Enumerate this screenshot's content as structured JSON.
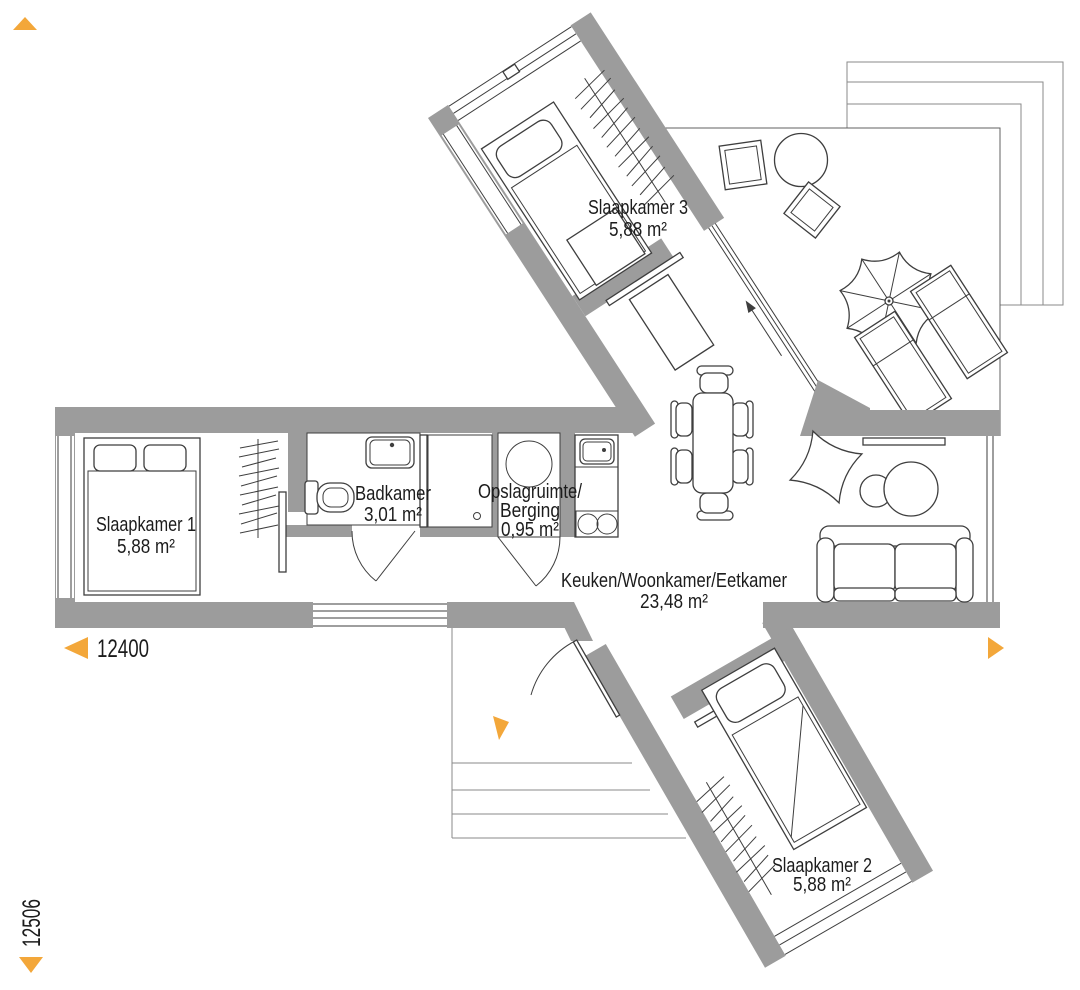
{
  "plan": {
    "colors": {
      "wall": "#9c9c9c",
      "line": "#3e3e3e",
      "accent": "#f3a73a",
      "text": "#1c1c1c"
    },
    "rooms": {
      "slaapkamer1": {
        "name": "Slaapkamer 1",
        "area": "5,88 m²"
      },
      "slaapkamer2": {
        "name": "Slaapkamer 2",
        "area": "5,88 m²"
      },
      "slaapkamer3": {
        "name": "Slaapkamer 3",
        "area": "5,88 m²"
      },
      "badkamer": {
        "name": "Badkamer",
        "area": "3,01 m²"
      },
      "opslag": {
        "line1": "Opslagruimte/",
        "line2": "Berging",
        "area": "0,95 m²"
      },
      "woonkamer": {
        "name": "Keuken/Woonkamer/Eetkamer",
        "area": "23,48 m²"
      }
    },
    "dimensions": {
      "width": "12400",
      "depth": "12506"
    }
  }
}
